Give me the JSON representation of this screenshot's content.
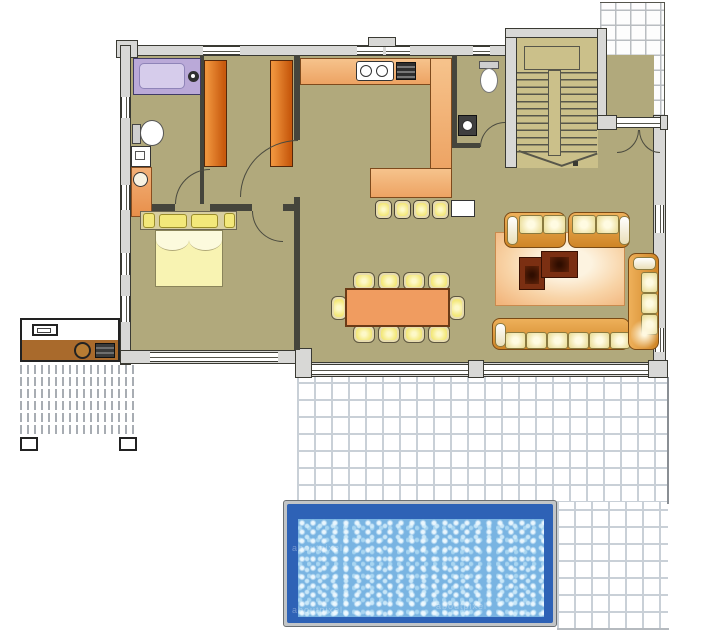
{
  "watermark": {
    "text": "aboutpixel"
  },
  "palette": {
    "floor": "#b1a97c",
    "stair_floor": "#cbc08a",
    "wall_fill": "#d8d8d6",
    "wall_line": "#3a3a33",
    "partition": "#45453c",
    "terrace_tile_line": "#c9d0d7",
    "porch_tile_line": "#b9bdc1",
    "bathtub": "#baa9d8",
    "wardrobe": "#d96a17",
    "kitchen_counter": "#f3b77e",
    "dining_table": "#f09c60",
    "sofa": "#e2a047",
    "cushion": "#f6efd2",
    "pillow": "#f3e87a",
    "rug_edge": "#f2b57c",
    "rug_center": "#fdf3e0",
    "coffee_table": "#7b2f12",
    "bed_blanket": "#f8f3b2",
    "deck_counter": "#a96a2c",
    "pool_frame": "#c2c5c7",
    "pool_deep": "#2e62b6",
    "pool_water": "#79b4e2"
  },
  "inventory": {
    "rooms": [
      "bathroom",
      "dressing-area",
      "bedroom",
      "kitchen",
      "wc",
      "staircase",
      "living-dining-room",
      "entry-porch",
      "terrace",
      "swimming-pool",
      "outdoor-kitchen-deck"
    ],
    "dining_chairs": 10,
    "bar_stools": 4,
    "wardrobes": 2,
    "sofas": 4,
    "coffee_tables": 2,
    "bed_pillows": 4,
    "stair_flights": 2
  }
}
